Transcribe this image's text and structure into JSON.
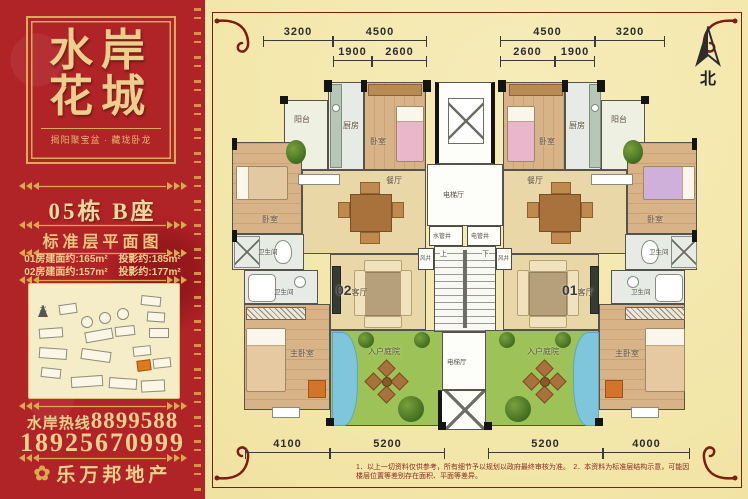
{
  "panel": {
    "title_line1": "水岸",
    "title_line2": "花城",
    "subtitle": "揭阳聚宝盆 · 藏珑卧龙",
    "building": "05栋 B座",
    "plan_title": "标准层平面图",
    "areas": [
      {
        "left": "01房建面约:165m²",
        "right": "投影约:185m²"
      },
      {
        "left": "02房建面约:157m²",
        "right": "投影约:177m²"
      }
    ],
    "hotline_label": "水岸热线",
    "hotline_number": "8899588",
    "mobile_number": "18925670999",
    "agency": "乐万邦地产",
    "sitemap_north": "北"
  },
  "icons": {
    "flower": "✿"
  },
  "plan": {
    "north": "北",
    "unit_left": "02",
    "unit_right": "01",
    "living": "客厅",
    "rooms": {
      "balcony": "阳台",
      "kitchen": "厨房",
      "bedroom": "卧室",
      "master": "主卧室",
      "bath": "卫生间",
      "dining": "餐厅",
      "courtyard": "入户庭院"
    },
    "core": {
      "hall": "电梯厅",
      "water": "水管井",
      "power": "电管井",
      "wind": "风井",
      "up": "上",
      "down": "下"
    },
    "dims": {
      "top": [
        "3200",
        "4500",
        "4500",
        "3200"
      ],
      "top_sub": [
        "1900",
        "2600",
        "2600",
        "1900"
      ],
      "bottom": [
        "4100",
        "5200",
        "5200",
        "4000"
      ]
    }
  },
  "footnote": "1．以上一切资料仅供参考，所有细节予以规划以政府最终审核为准。　2．本资料为标准层结构示意，可能因楼层位置等差别存在面积、平面等差异。"
}
